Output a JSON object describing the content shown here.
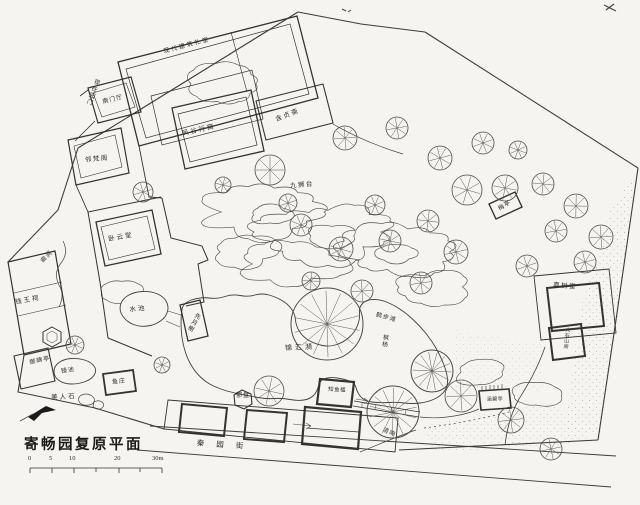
{
  "drawing_title": "寄畅园复原平面",
  "scale_bar": {
    "ticks": [
      "0",
      "5",
      "10",
      "20"
    ],
    "end": "30m"
  },
  "labels": [
    {
      "id": "note-modern-building",
      "text": "现代建筑礼堂",
      "x": 187,
      "y": 46,
      "rot": -15,
      "fs": 6,
      "ls": 2
    },
    {
      "id": "current-garden-gate",
      "text": "现在园门",
      "x": 92,
      "y": 92,
      "rot": 20,
      "fs": 6,
      "ls": 1,
      "vert": true
    },
    {
      "id": "south-gate-hall",
      "text": "南门厅",
      "x": 113,
      "y": 100,
      "rot": -14,
      "fs": 6,
      "ls": 1
    },
    {
      "id": "fenggu-xingwo",
      "text": "凤谷行窝",
      "x": 199,
      "y": 131,
      "rot": -13,
      "fs": 6.5,
      "ls": 2
    },
    {
      "id": "linfan-ge",
      "text": "邻梵阁",
      "x": 97,
      "y": 160,
      "rot": -6,
      "fs": 6.5,
      "ls": 1.5
    },
    {
      "id": "hanzhen-zhai",
      "text": "含贞斋",
      "x": 288,
      "y": 116,
      "rot": -21,
      "fs": 6.5,
      "ls": 2
    },
    {
      "id": "jiushi-tai",
      "text": "九狮台",
      "x": 302,
      "y": 186,
      "rot": -5,
      "fs": 6.5,
      "ls": 1.5
    },
    {
      "id": "mei-ting",
      "text": "梅亭",
      "x": 505,
      "y": 206,
      "rot": -32,
      "fs": 6,
      "ls": 1
    },
    {
      "id": "woyun-tang",
      "text": "卧云堂",
      "x": 121,
      "y": 238,
      "rot": -10,
      "fs": 6.5,
      "ls": 2
    },
    {
      "id": "qu-jian",
      "text": "曲涧",
      "x": 47,
      "y": 257,
      "rot": -45,
      "fs": 6,
      "ls": 1
    },
    {
      "id": "qianwang-ci",
      "text": "钱王祠",
      "x": 28,
      "y": 301,
      "rot": -10,
      "fs": 6.5,
      "ls": 2
    },
    {
      "id": "shui-chi",
      "text": "水池",
      "x": 138,
      "y": 310,
      "rot": -5,
      "fs": 6.5,
      "ls": 2
    },
    {
      "id": "xianyue-xie",
      "text": "先月榭",
      "x": 193,
      "y": 322,
      "rot": 28,
      "fs": 6,
      "ls": 1,
      "vert": true
    },
    {
      "id": "jinhui-yi",
      "text": "锦汇漪",
      "x": 300,
      "y": 348,
      "rot": -3,
      "fs": 7,
      "ls": 3
    },
    {
      "id": "hebu-tan",
      "text": "鹤步滩",
      "x": 386,
      "y": 318,
      "rot": 16,
      "fs": 6,
      "ls": 1
    },
    {
      "id": "fengyang-tree",
      "text": "枫杨",
      "x": 384,
      "y": 341,
      "rot": 8,
      "fs": 6,
      "ls": 1,
      "vert": true
    },
    {
      "id": "jiashu-tang",
      "text": "嘉树堂",
      "x": 565,
      "y": 287,
      "rot": 4,
      "fs": 6.5,
      "ls": 1.5
    },
    {
      "id": "dashi-shanfang",
      "text": "大石山房",
      "x": 566,
      "y": 338,
      "rot": 6,
      "fs": 5,
      "ls": 0.5,
      "vert": true
    },
    {
      "id": "yubei-ting",
      "text": "御碑亭",
      "x": 40,
      "y": 361,
      "rot": -12,
      "fs": 6,
      "ls": 1
    },
    {
      "id": "jing-chi",
      "text": "镜池",
      "x": 68,
      "y": 371,
      "rot": -8,
      "fs": 6,
      "ls": 1
    },
    {
      "id": "meiren-shi",
      "text": "美人石",
      "x": 64,
      "y": 398,
      "rot": -3,
      "fs": 6.5,
      "ls": 2
    },
    {
      "id": "yu-zhuang",
      "text": "鱼庄",
      "x": 119,
      "y": 382,
      "rot": -5,
      "fs": 6,
      "ls": 1
    },
    {
      "id": "yu-pan",
      "text": "郁盘",
      "x": 243,
      "y": 396,
      "rot": 0,
      "fs": 6,
      "ls": 1
    },
    {
      "id": "zhiyu-jian",
      "text": "知鱼槛",
      "x": 337,
      "y": 391,
      "rot": 3,
      "fs": 5.5,
      "ls": 0.5
    },
    {
      "id": "qing-xiang",
      "text": "清响",
      "x": 389,
      "y": 433,
      "rot": 24,
      "fs": 6,
      "ls": 1
    },
    {
      "id": "hanbi-ting",
      "text": "涵碧亭",
      "x": 495,
      "y": 400,
      "rot": -2,
      "fs": 5,
      "ls": 0.5
    },
    {
      "id": "street-name",
      "text": "秦园街",
      "x": 226,
      "y": 445,
      "rot": 4,
      "fs": 7.5,
      "ls": 12
    }
  ]
}
